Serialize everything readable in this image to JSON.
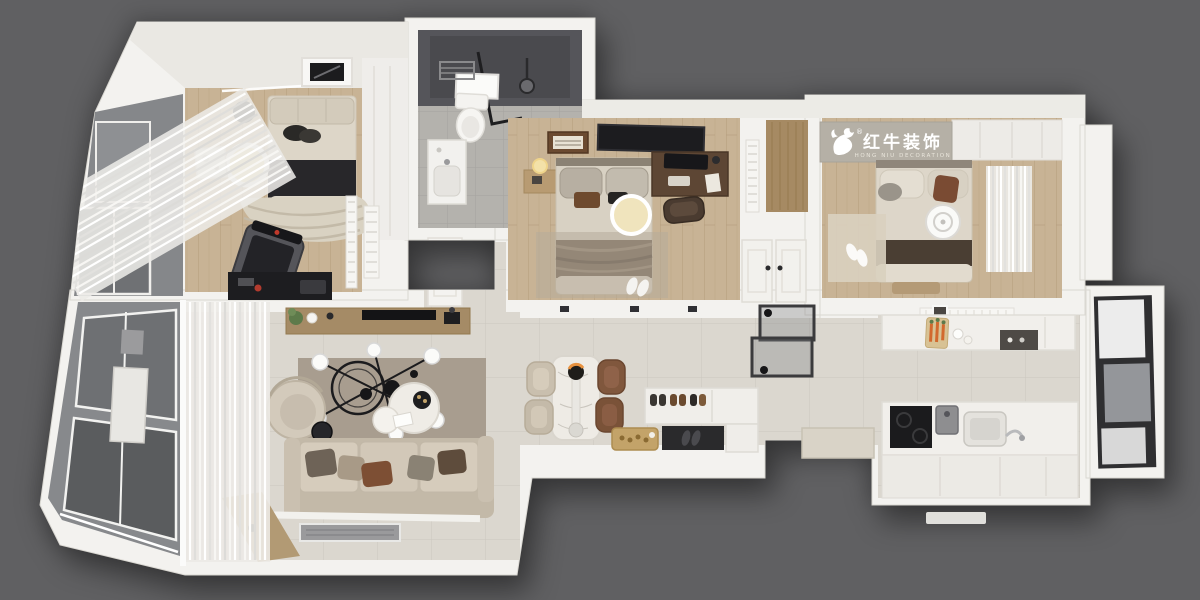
{
  "brand": {
    "zh": "红牛装饰",
    "en": "HONG NIU DECORATION",
    "registered": "®"
  },
  "palette": {
    "background": "#606062",
    "wall": "#f3f2ef",
    "ceiling": "#eae8e3",
    "wood_floor": "#c8b395",
    "tile_floor": "#dbd7cf",
    "bath_tile": "#b4b2ad",
    "shower_dark": "#55555a",
    "brand_band": "#b5b0a6",
    "brand_text": "#ffffff",
    "balcony_glass": "#87898c",
    "window_frame_dark": "#2f2f31",
    "sofa": "#cfc5b5",
    "living_rug": "#a89d8f",
    "accent_rust": "#7d4f34",
    "walnut_desk": "#5d4634",
    "black_fixture": "#1d1d20",
    "marble_table": "#eeebe5",
    "brass_tray": "#c3a369",
    "entry_mat": "#2a2a2c",
    "lamp_glow": "#f1e3ae",
    "curtain": "#efeeea"
  }
}
